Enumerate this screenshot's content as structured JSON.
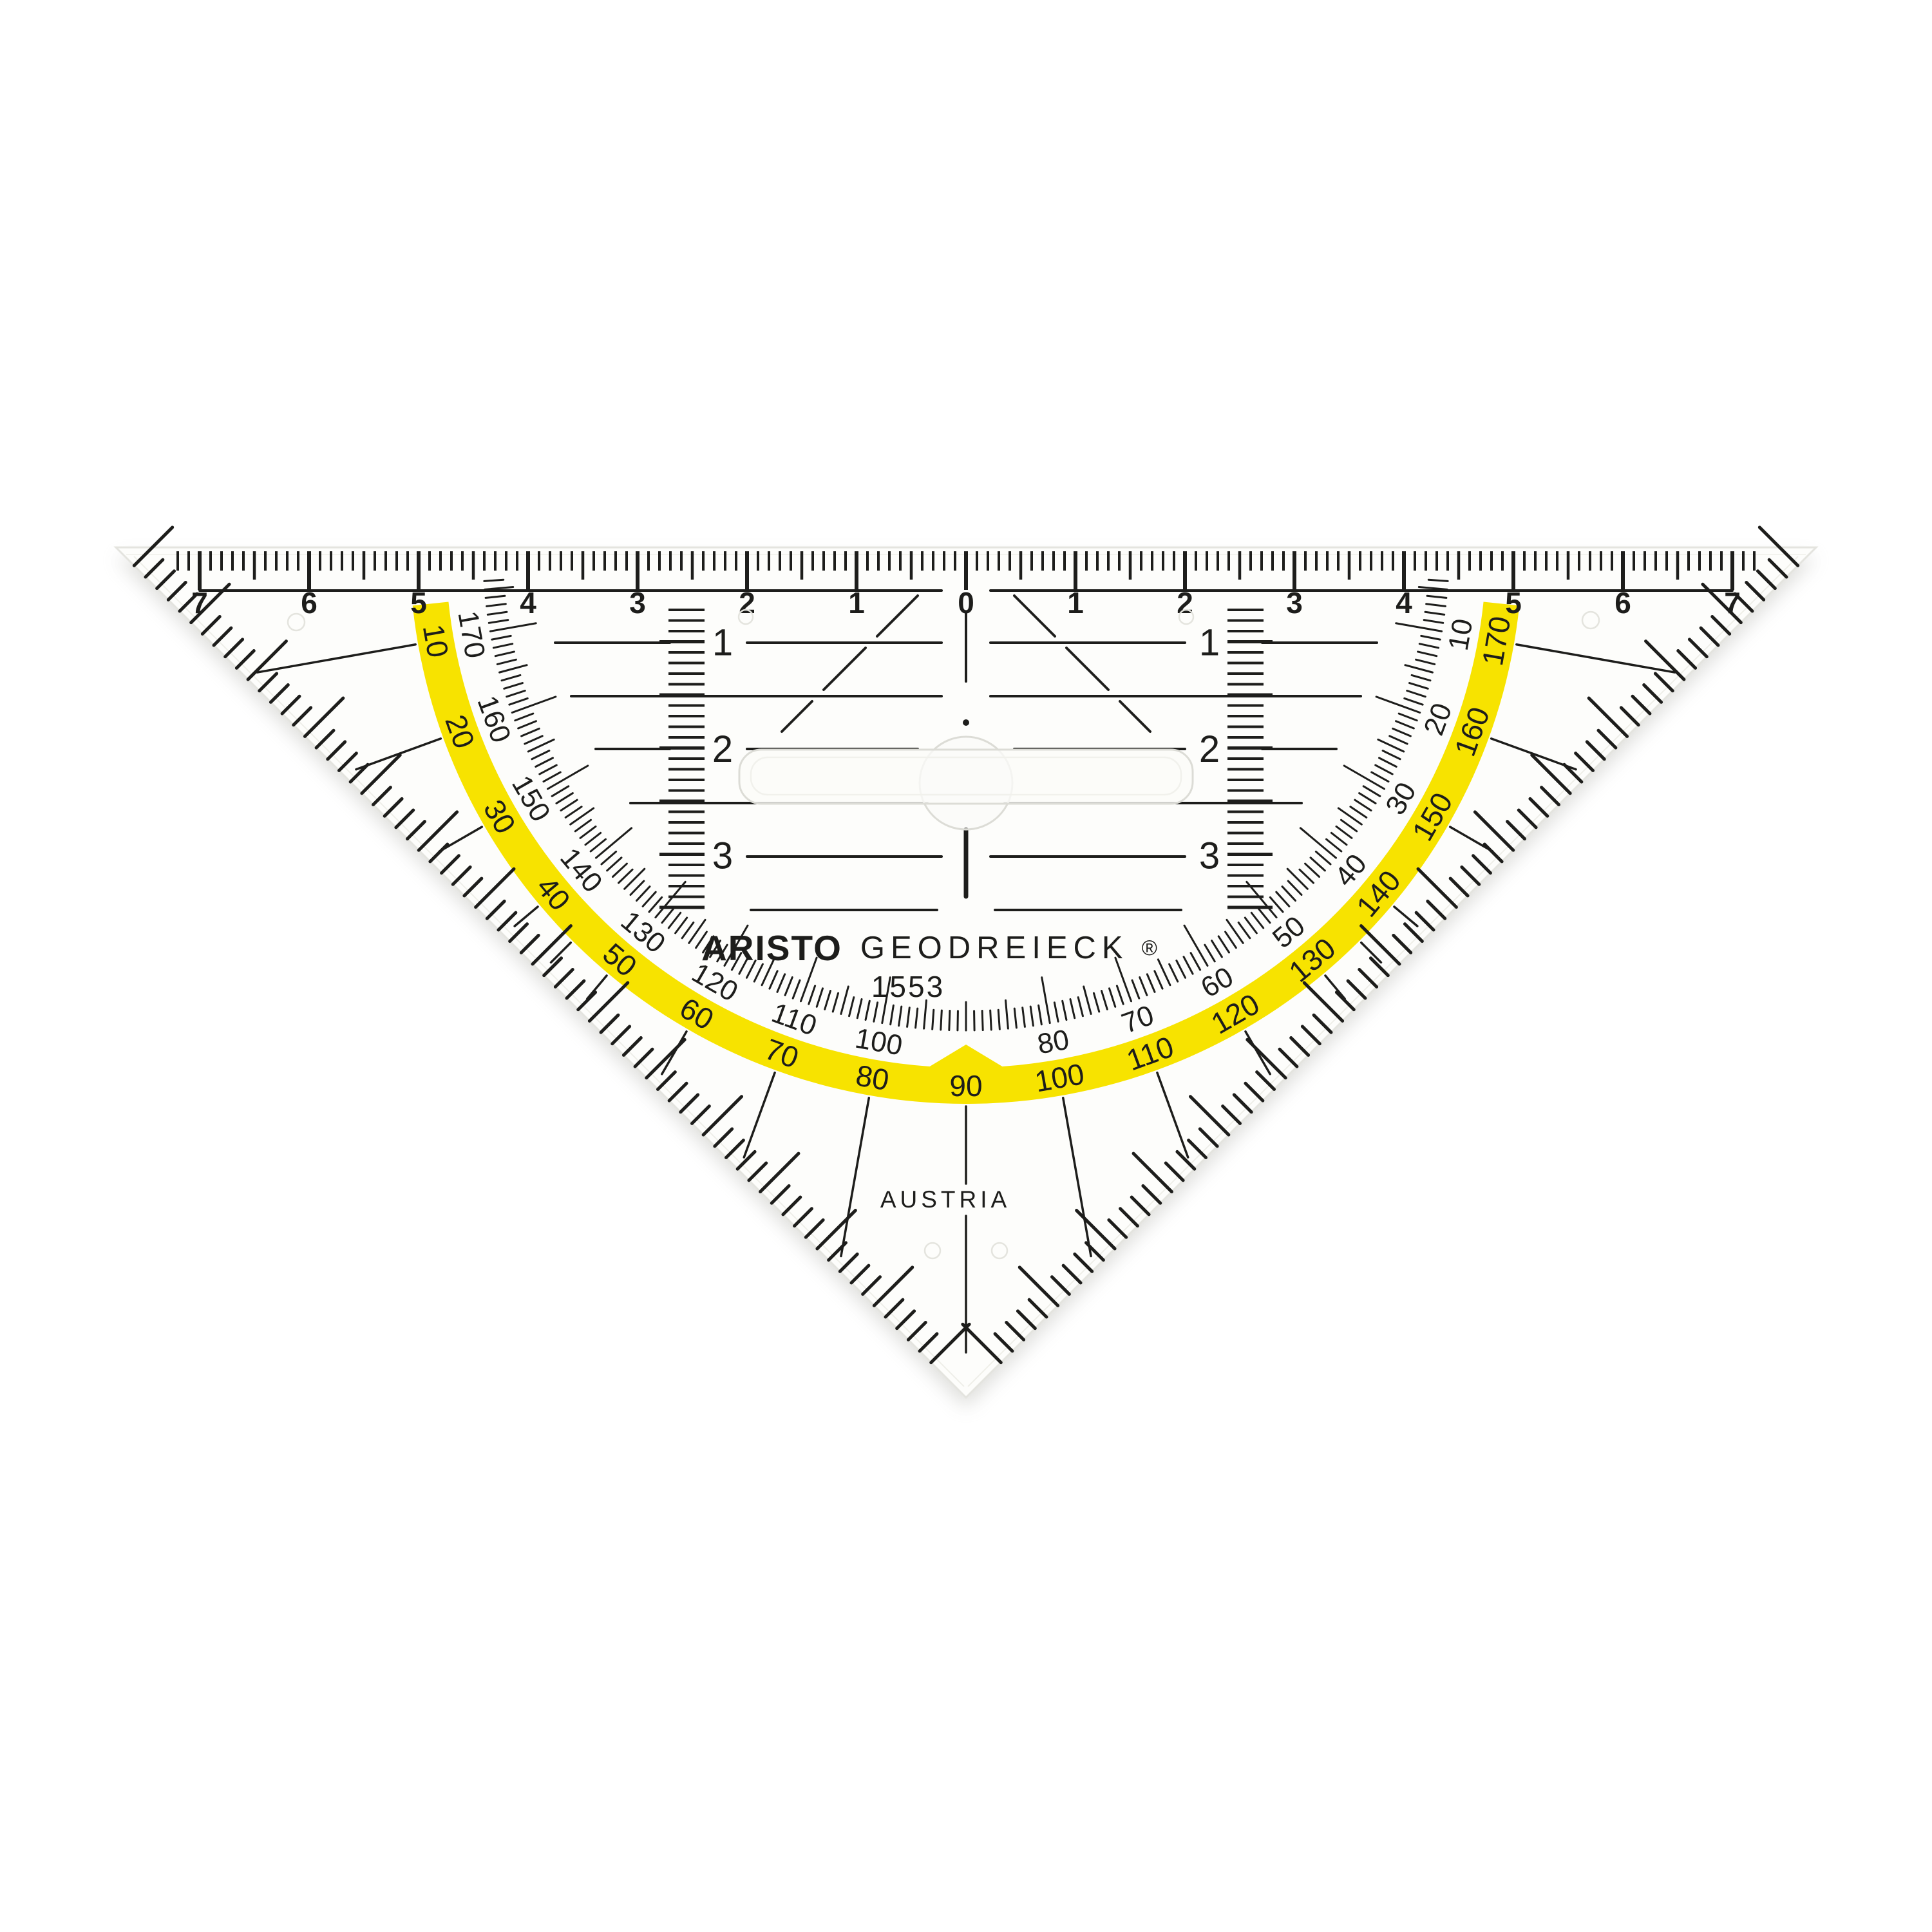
{
  "scene": {
    "object": "ARISTO Geodreieck 1553 transparent geometry set square with protractor",
    "background": "#ffffff"
  },
  "colors": {
    "ink": "#1d1d1b",
    "yellow_arc": "#f7e300",
    "body": "#fdfdfb",
    "edge": "#e4e4df",
    "bevel": "#efefe9",
    "shadow": "#b9b9b3",
    "plastic_detail": "#dcdcd6"
  },
  "ruler_cm": {
    "zero": "0",
    "left": [
      "1",
      "2",
      "3",
      "4",
      "5",
      "6",
      "7"
    ],
    "right": [
      "1",
      "2",
      "3",
      "4",
      "5",
      "6",
      "7"
    ]
  },
  "parallel_guide": {
    "row_labels": [
      "1",
      "2",
      "3"
    ]
  },
  "protractor": {
    "outer_scale_on_yellow": [
      10,
      20,
      30,
      40,
      50,
      60,
      70,
      80,
      90,
      100,
      110,
      120,
      130,
      140,
      150,
      160,
      170
    ],
    "inner_scale": [
      10,
      20,
      30,
      40,
      50,
      60,
      70,
      80,
      100,
      110,
      120,
      130,
      140,
      150,
      160,
      170
    ],
    "inner_scale_omits": "90",
    "tick_step_degrees": 1
  },
  "branding": {
    "logo": "ARISTO",
    "product": "GEODREIECK",
    "registered": "®",
    "model": "1553",
    "origin": "AUSTRIA"
  }
}
